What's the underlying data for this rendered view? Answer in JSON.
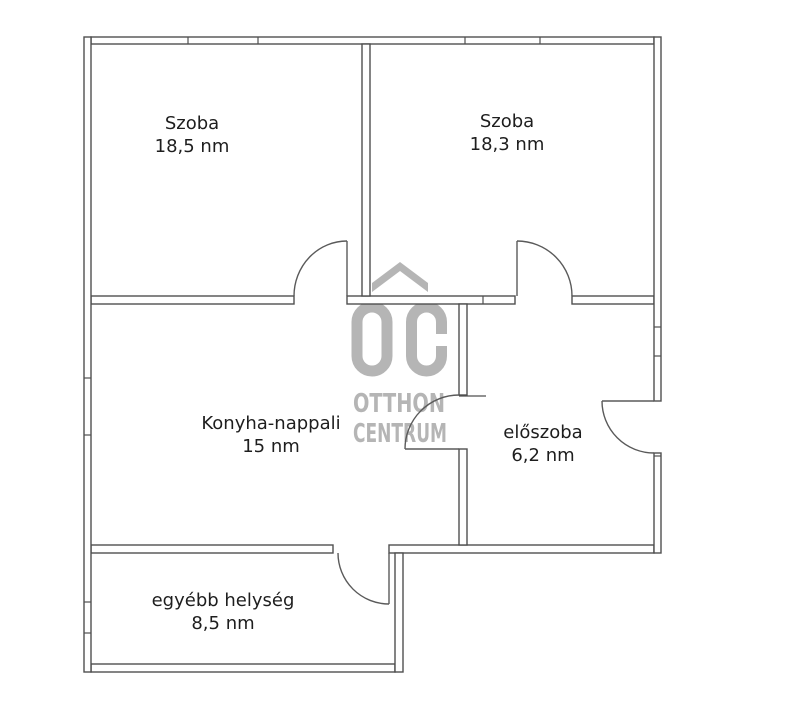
{
  "watermark": {
    "logo_text": "ŐC",
    "line1": "OTTHON",
    "line2": "CENTRUM",
    "color": "#b5b5b5"
  },
  "rooms": [
    {
      "name": "Szoba",
      "area": "18,5 nm"
    },
    {
      "name": "Szoba",
      "area": "18,3 nm"
    },
    {
      "name": "Konyha-nappali",
      "area": "15 nm"
    },
    {
      "name": "előszoba",
      "area": "6,2 nm"
    },
    {
      "name": "egyébb helység",
      "area": "8,5 nm"
    }
  ],
  "colors": {
    "wall_line": "#4f4f4f",
    "label_text": "#1e1e1e",
    "watermark": "#b5b5b5",
    "background": "#ffffff"
  }
}
